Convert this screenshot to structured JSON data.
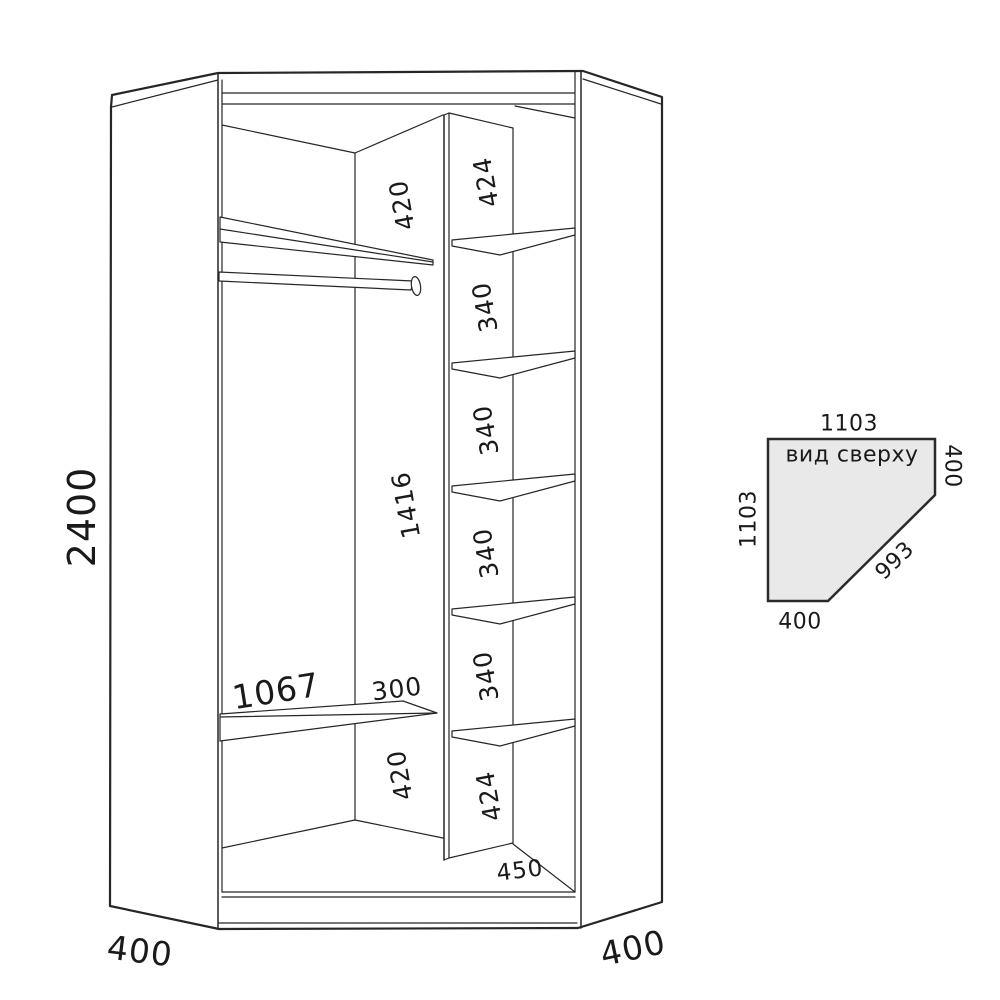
{
  "colors": {
    "line": "#262626",
    "text": "#1a1a1a",
    "top_view_fill": "#e9e9e9"
  },
  "main_view": {
    "height": "2400",
    "side_depth_left": "400",
    "side_depth_right": "400",
    "hanging_section": {
      "top_gap": "420",
      "middle_height": "1416",
      "shelf_length": "1067",
      "gap_right": "300",
      "bottom_gap": "420"
    },
    "shelf_column": {
      "top_section": "424",
      "middle_sections": [
        "340",
        "340",
        "340",
        "340"
      ],
      "bottom_section": "424",
      "column_width": "450"
    }
  },
  "top_view": {
    "label": "вид сверху",
    "top_width": "1103",
    "right_depth": "400",
    "left_depth": "1103",
    "diagonal_front": "993",
    "bottom_width": "400"
  }
}
